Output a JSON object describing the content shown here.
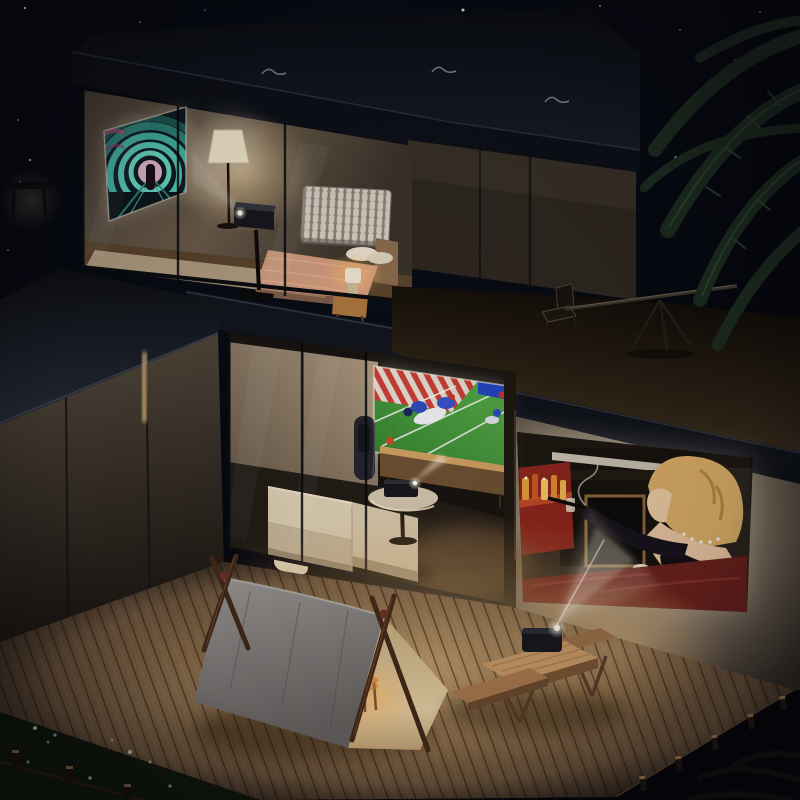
{
  "meta": {
    "description": "Night-time 3D rendered cutaway of a modern two-storey smart home; four portable projectors cast images in the bedroom, living room, on the exterior wall and from a picnic table on a wooden deck",
    "canvas": {
      "width": 800,
      "height": 800
    }
  },
  "palette": {
    "sky": "#04060c",
    "roof_slab": "#11151d",
    "concrete_wall": "#55493c",
    "deck_wood_lit": "#c9a478",
    "deck_wood_dark": "#4a3828",
    "tent_canvas": "#8a8684",
    "tent_lining": "#e2cda2",
    "tunnel_teal": "#3fb3a1",
    "tunnel_magenta": "#b04878",
    "field_green": "#3e8c38",
    "jersey_blue": "#2f46b4",
    "endzone_red": "#c23b34",
    "sofa_cream": "#d9cbb0",
    "blanket_salmon": "#cf9a7c",
    "movie_couch_red": "#6a211c",
    "hair_blonde": "#d9ad66",
    "bottle_amber": "#d98a2e",
    "lamp_warm": "#f5d9a8",
    "beam_white": "#ffffff",
    "grass": "#16200f",
    "palm_green": "#1c2b1f"
  },
  "scene": {
    "sky": {
      "label": "night sky with scattered stars",
      "star_count": 17
    },
    "palm_tree": {
      "label": "palm frond silhouettes, top right"
    },
    "building": {
      "roof": {
        "label": "flat dark roof slab with small rooftop vents"
      },
      "bedroom": {
        "label": "upstairs bedroom behind glass wall",
        "objects": {
          "projection": "neon teal tunnel movie projected on wall screen",
          "projector": "black projector on pedestal stand",
          "floor_lamp": "lit beige floor lamp",
          "radiator": "white column radiator",
          "bed": "bed with salmon blanket and pillows",
          "nightstand": "wood stool nightstand with small lit lamp"
        }
      },
      "terrace": {
        "label": "dark rooftop terrace",
        "objects": {
          "telescope": "telescope on tripod",
          "chair": "folding chair"
        }
      },
      "living_room": {
        "label": "ground floor living room behind glass sliding wall",
        "objects": {
          "projection": "american football game projected above media console",
          "panels": "warm beige wall panels",
          "sofa": "cream fabric sofa",
          "side_table": "round side table with black projector",
          "console": "low wooden media console with small red plant",
          "door_panel": "dark handle panel on sliding glass door"
        }
      },
      "outdoor_cinema_wall": {
        "label": "right exterior concrete wall used as cinema screen",
        "projection": "classic movie scene: blonde woman in black gown on red couch beside fireplace and amber drinks cart"
      },
      "left_wing": {
        "label": "low side wing with slate roof, concrete panels and warm light slit"
      }
    },
    "deck": {
      "label": "warm-lit diagonal wooden plank deck",
      "objects": {
        "tent": "A-frame play tent, grey canvas front, cream lining, crossed wood poles",
        "stool": "small orange stool glowing inside tent",
        "picnic_table": "wooden picnic table with benches",
        "projector": "black portable projector beaming up at the wall screen"
      }
    },
    "garden": {
      "label": "dark lawn with tiny white flowers and low wooden fences",
      "objects": {
        "flowers": "white wildflowers",
        "fence": "low timber fence posts"
      }
    }
  }
}
